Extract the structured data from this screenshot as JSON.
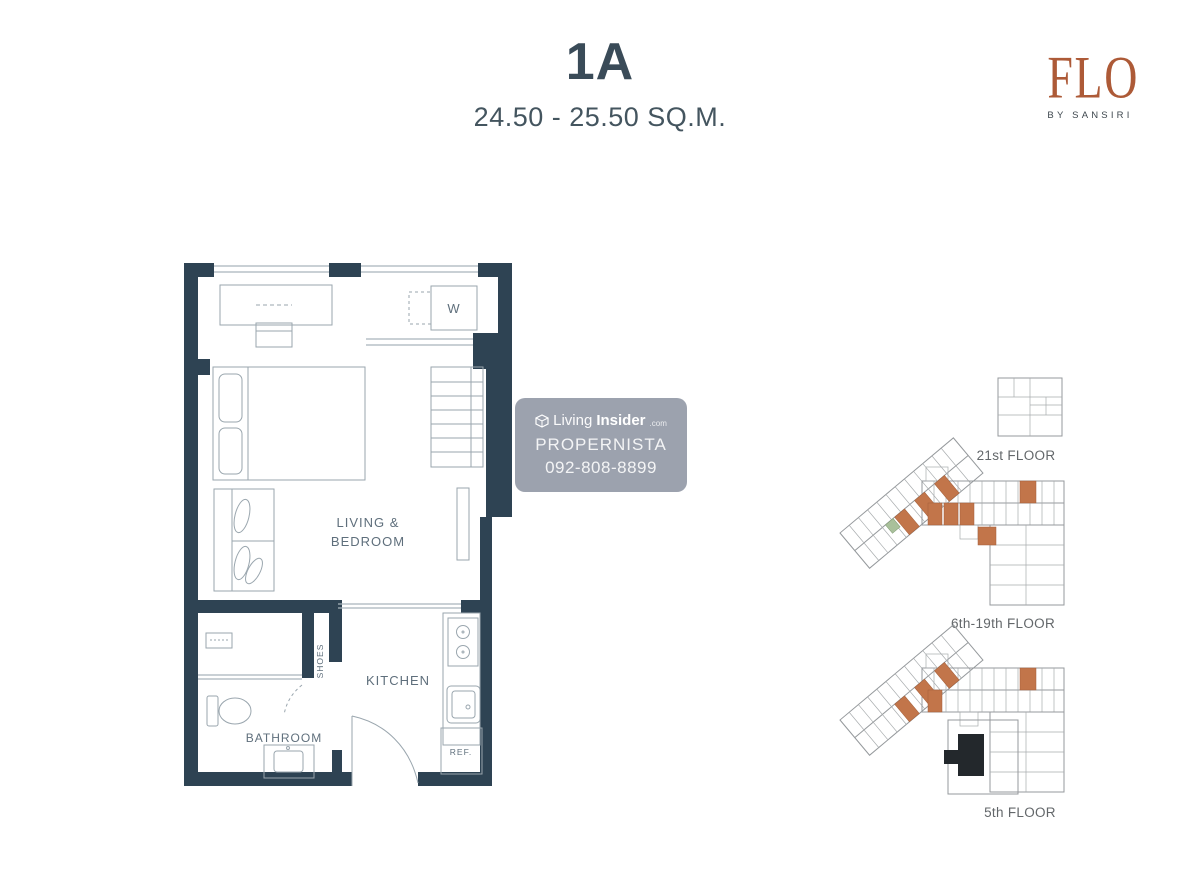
{
  "header": {
    "unit_name": "1A",
    "area_range": "24.50 - 25.50 SQ.M."
  },
  "brand": {
    "name": "FLO",
    "byline": "BY SANSIRI"
  },
  "unit_plan": {
    "labels": {
      "living_line1": "LIVING &",
      "living_line2": "BEDROOM",
      "kitchen": "KITCHEN",
      "bathroom": "BATHROOM",
      "shoes": "SHOES",
      "washer": "W",
      "fridge": "REF."
    }
  },
  "key_plans": {
    "floors": [
      {
        "label": "21st FLOOR"
      },
      {
        "label": "6th-19th FLOOR"
      },
      {
        "label": "5th FLOOR"
      }
    ],
    "highlight_color": "#c2754a"
  },
  "watermark": {
    "brand_prefix": "Living",
    "brand_suffix": "Insider",
    "brand_tld": ".com",
    "line2": "PROPERNISTA",
    "line3": "092-808-8899"
  },
  "colors": {
    "wall": "#2e4353",
    "title": "#3a4b58",
    "brand_rust": "#ad5a37",
    "highlight_orange": "#c2754a"
  }
}
